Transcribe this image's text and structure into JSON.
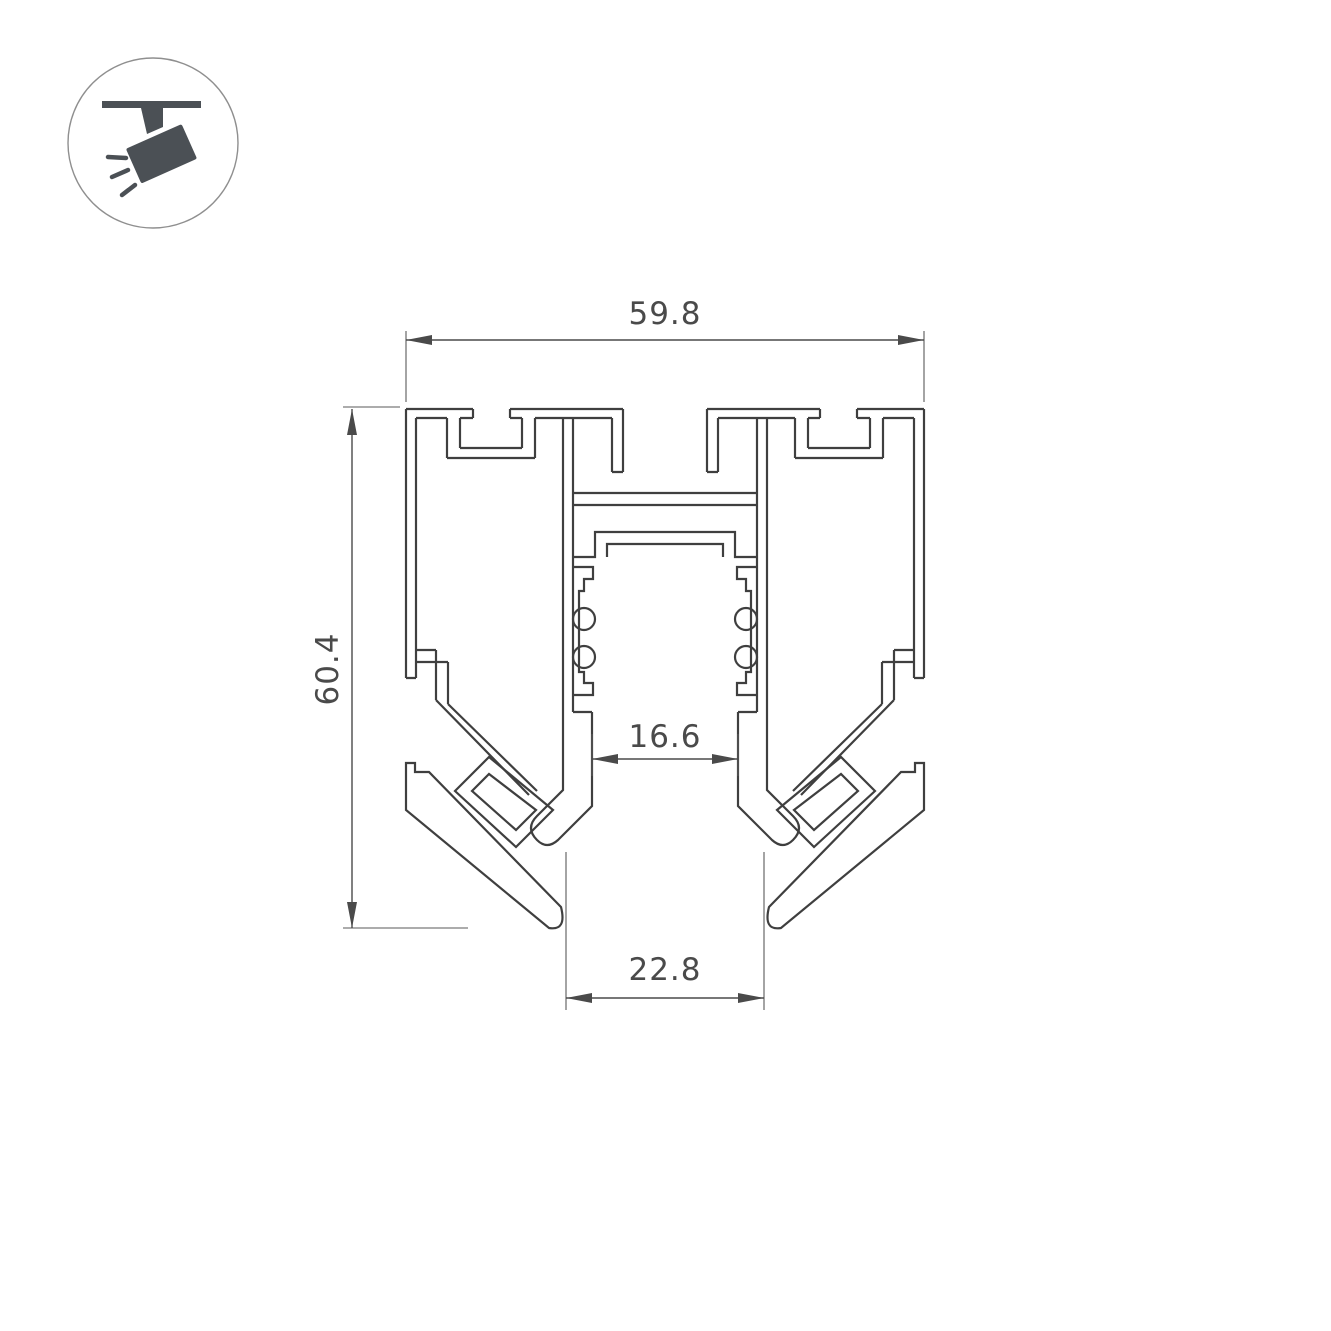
{
  "page": {
    "background": "#ffffff"
  },
  "colors": {
    "profile_line": "#3f3f3f",
    "dimension_line": "#4a4a4a",
    "extension_line": "#5a5a5a",
    "text": "#4a4a4a",
    "icon_fill": "#4b5055",
    "icon_circle_border": "#8f8f8f"
  },
  "icon": {
    "name": "ceiling-track-spotlight",
    "description": "spotlight hanging from ceiling track with light rays"
  },
  "drawing": {
    "type": "profile-cross-section",
    "subject": "recessed magnetic track lighting profile",
    "dimensions": {
      "overall_width": "59.8",
      "overall_height": "60.4",
      "track_opening_width": "16.6",
      "bottom_opening_width": "22.8"
    }
  }
}
